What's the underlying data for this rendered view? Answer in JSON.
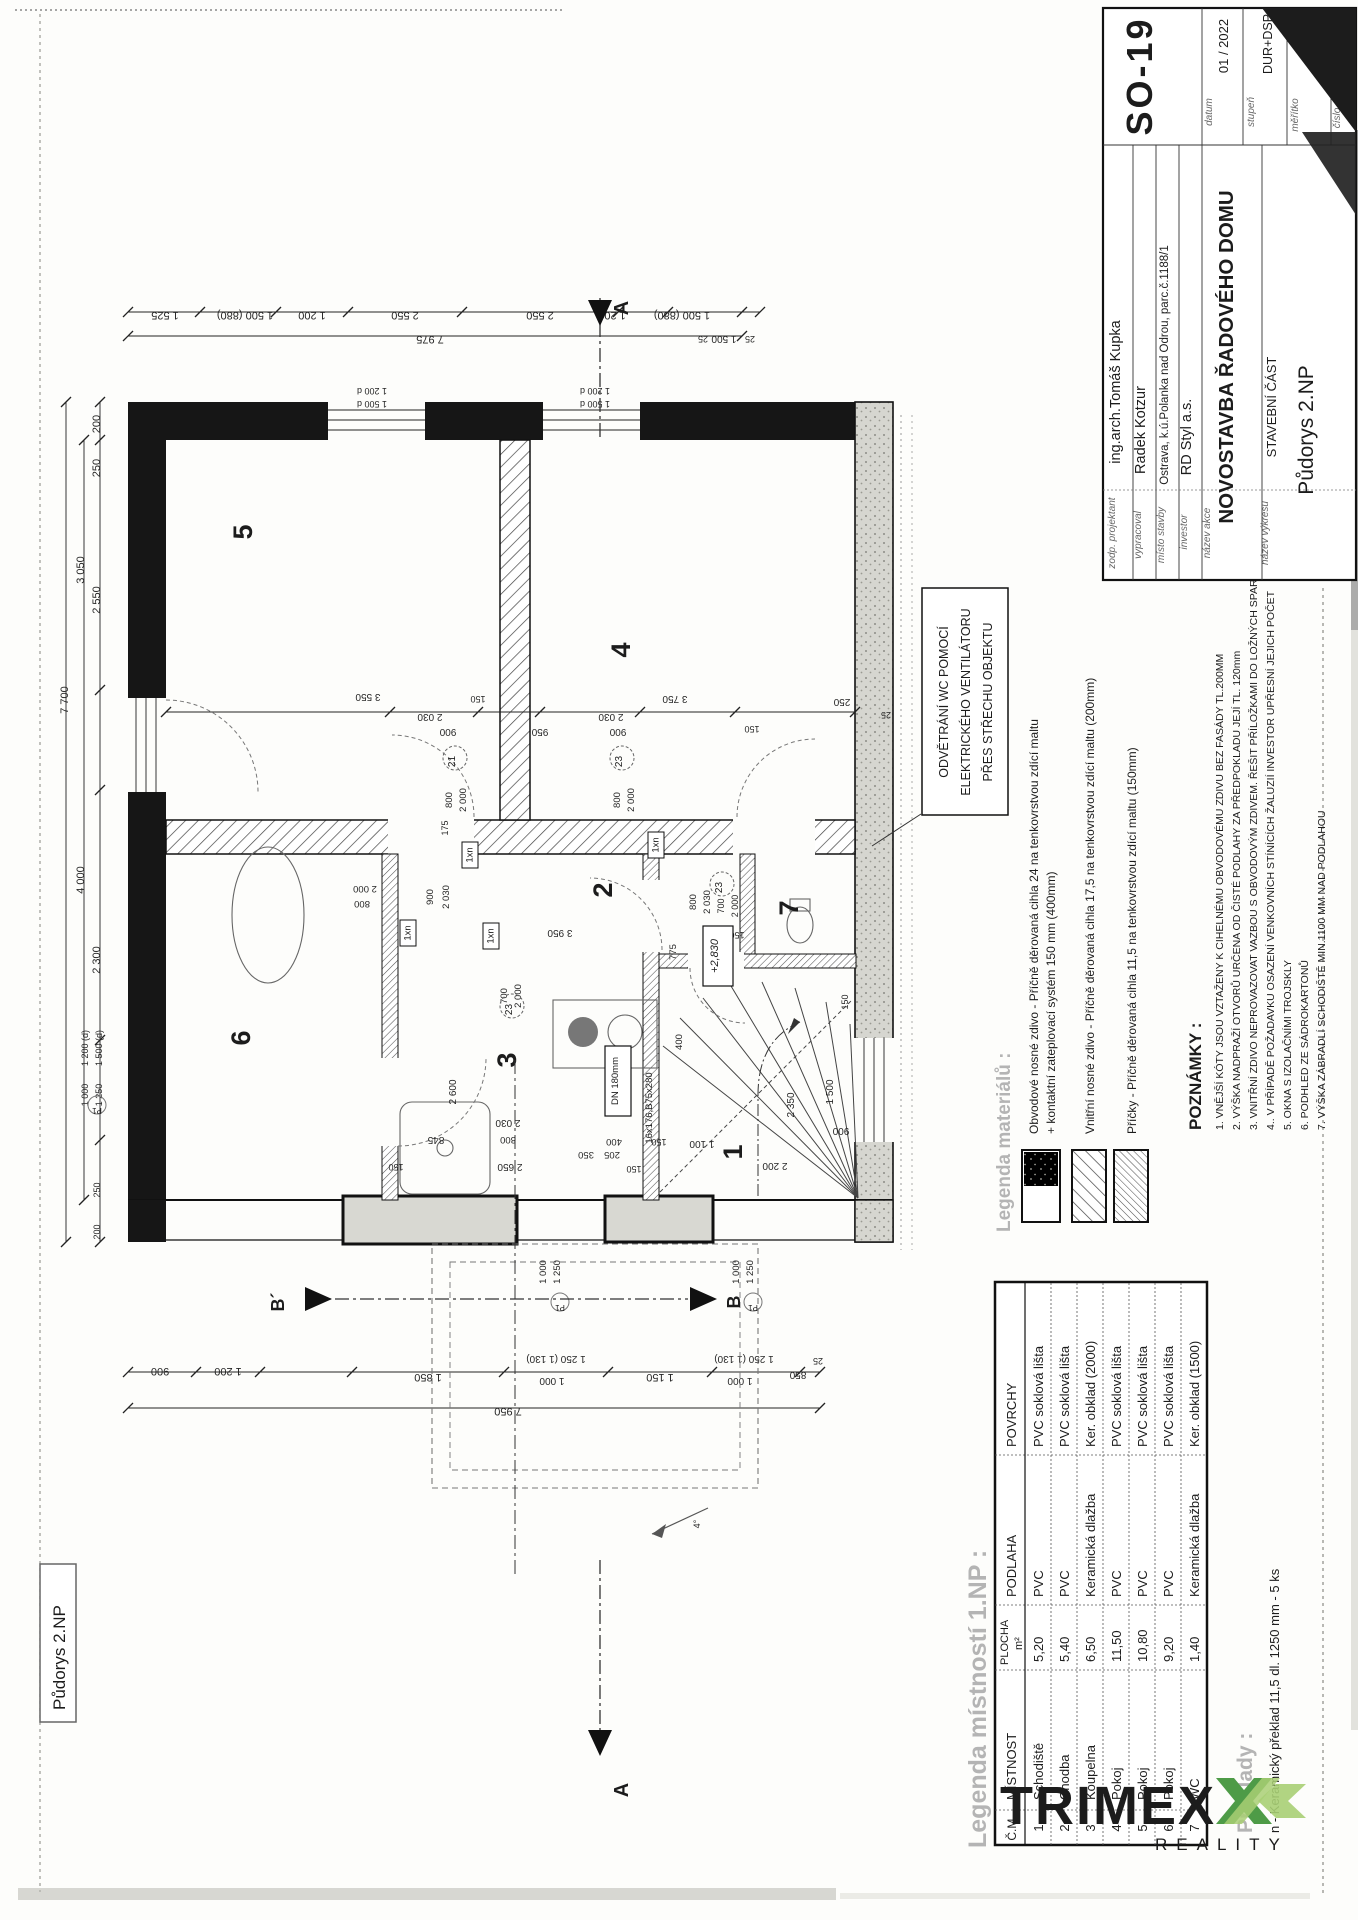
{
  "frame_label": "Půdorys 2.NP",
  "title_block": {
    "rows": [
      {
        "label": "zodp. projektant",
        "value": "ing.arch.Tomáš Kupka"
      },
      {
        "label": "vypracoval",
        "value": "Radek Kotzur"
      },
      {
        "label": "místo stavby",
        "value": "Ostrava, k.ú.Polanka nad Odrou, parc.č.1188/1"
      },
      {
        "label": "investor",
        "value": "RD Styl a.s."
      },
      {
        "label": "název akce",
        "value": "NOVOSTAVBA ŘADOVÉHO DOMU"
      },
      {
        "label": "název výkresu",
        "value_line1": "STAVEBNÍ ČÁST",
        "value_line2": "Půdorys 2.NP"
      }
    ],
    "meta": {
      "datum_label": "datum",
      "datum": "01 / 2022",
      "stupen_label": "stupeň",
      "stupen": "DUR+DSP",
      "meritko_label": "měřítko",
      "meritko": "1:50",
      "cislo_label": "číslo",
      "drawing_no": "SO-19"
    }
  },
  "callout": {
    "lines": [
      "ODVĚTRÁNÍ WC POMOCÍ",
      "ELEKTRICKÉHO VENTILÁTORU",
      "PŘES STŘECHU OBJEKTU"
    ]
  },
  "legend_materials": {
    "title": "Legenda materiálů :",
    "items": [
      {
        "line1": "Obvodové nosné zdivo - Příčně děrovaná cihla 24 na tenkovrstvou zdící maltu",
        "line2": "+ kontaktní zateplovací systém 150 mm (400mm)"
      },
      {
        "line1": "Vnitřní nosné zdivo - Příčně děrovaná cihla 17,5 na tenkovrstvou zdící maltu (200mm)",
        "line2": ""
      },
      {
        "line1": "Příčky - Příčně děrovaná cihla 11,5 na tenkovrstvou zdící maltu (150mm)",
        "line2": ""
      }
    ]
  },
  "notes": {
    "title": "POZNÁMKY :",
    "items": [
      "1. VNĚJŠÍ KÓTY JSOU VZTAŽENY K CIHELNÉMU OBVODOVÉMU ZDIVU BEZ FASÁDY TL.200MM",
      "2. VÝŠKA NADPRAŽÍ OTVORŮ URČENA OD ČISTÉ PODLAHY ZA PŘEDPOKLADU JEJÍ TL. 120mm",
      "3. VNITŘNÍ ZDIVO NEPROVAZOVAT VAZBOU S OBVODOVÝM ZDIVEM. ŘEŠIT PŘÍLOŽKAMI DO LOŽNÝCH SPAR",
      "4.. V PŘÍPADĚ POŽADAVKU OSAZENÍ VENKOVNÍCH STÍNÍCÍCH ŽALUZIÍ INVESTOR UPŘESNÍ JEJICH POČET",
      "5. OKNA S IZOLAČNÍMI TROJSKLY",
      "6. PODHLED ZE SÁDROKARTONŮ",
      "7. VÝŠKA ZÁBRADLÍ SCHODIŠTĚ MIN.1100 MM NAD PODLAHOU"
    ]
  },
  "room_table": {
    "title": "Legenda místností 1.NP :",
    "headers": {
      "cm": "Č.M.",
      "mistnost": "MÍSTNOST",
      "plocha1": "PLOCHA",
      "plocha2": "m²",
      "podlaha": "PODLAHA",
      "povrchy": "POVRCHY"
    },
    "rows": [
      {
        "cm": "1",
        "mistnost": "Schodiště",
        "plocha": "5,20",
        "podlaha": "PVC",
        "povrchy": "PVC soklová lišta"
      },
      {
        "cm": "2",
        "mistnost": "Chodba",
        "plocha": "5,40",
        "podlaha": "PVC",
        "povrchy": "PVC soklová lišta"
      },
      {
        "cm": "3",
        "mistnost": "Koupelna",
        "plocha": "6,50",
        "podlaha": "Keramická dlažba",
        "povrchy": "Ker. obklad (2000)"
      },
      {
        "cm": "4",
        "mistnost": "Pokoj",
        "plocha": "11,50",
        "podlaha": "PVC",
        "povrchy": "PVC soklová lišta"
      },
      {
        "cm": "5",
        "mistnost": "Pokoj",
        "plocha": "10,80",
        "podlaha": "PVC",
        "povrchy": "PVC soklová lišta"
      },
      {
        "cm": "6",
        "mistnost": "Pokoj",
        "plocha": "9,20",
        "podlaha": "PVC",
        "povrchy": "PVC soklová lišta"
      },
      {
        "cm": "7",
        "mistnost": "WC",
        "plocha": "1,40",
        "podlaha": "Keramická dlažba",
        "povrchy": "Ker. obklad (1500)"
      }
    ]
  },
  "preklady": {
    "title": "Překlady :",
    "line": "n - Keramický překlad 11,5 dl. 1250  mm -   5 ks"
  },
  "logo": {
    "brand": "TRIMEX",
    "tagline": "REALITY",
    "green": "#4e9b47",
    "light_green": "#a9cf74",
    "dark": "#4b4b55",
    "gray": "#9b9b9b"
  },
  "sections": {
    "a": "A",
    "b": "B",
    "b_prime": "B´"
  },
  "plan": {
    "boxes": {
      "level": "+2,830",
      "dn": "DN 180mm",
      "stair": "16x176,B75x280",
      "lintel": "1xn"
    },
    "rooms": [
      {
        "t": "5",
        "x": 252,
        "y": 532
      },
      {
        "t": "4",
        "x": 630,
        "y": 650
      },
      {
        "t": "2",
        "x": 612,
        "y": 890
      },
      {
        "t": "7",
        "x": 798,
        "y": 908
      },
      {
        "t": "6",
        "x": 250,
        "y": 1038
      },
      {
        "t": "3",
        "x": 516,
        "y": 1060
      },
      {
        "t": "1",
        "x": 742,
        "y": 1152
      }
    ],
    "door_tags": [
      {
        "t": "21",
        "x": 455,
        "y": 758
      },
      {
        "t": "23",
        "x": 622,
        "y": 758
      },
      {
        "t": "23",
        "x": 722,
        "y": 884
      },
      {
        "t": "23",
        "x": 512,
        "y": 1006
      }
    ],
    "p_tags": [
      {
        "t": "P1",
        "x": 560,
        "y": 1302
      },
      {
        "t": "P1",
        "x": 753,
        "y": 1302
      },
      {
        "t": "P1",
        "x": 97,
        "y": 1105
      }
    ],
    "dims": [
      {
        "t": "1 525",
        "x": 165,
        "y": 312,
        "r": 180
      },
      {
        "t": "1 500 (880)",
        "x": 245,
        "y": 312,
        "r": 180
      },
      {
        "t": "1 200",
        "x": 312,
        "y": 312,
        "r": 180
      },
      {
        "t": "2 550",
        "x": 405,
        "y": 312,
        "r": 180
      },
      {
        "t": "2 550",
        "x": 540,
        "y": 312,
        "r": 180
      },
      {
        "t": "1 200",
        "x": 612,
        "y": 312,
        "r": 180
      },
      {
        "t": "1 500 (880)",
        "x": 682,
        "y": 312,
        "r": 180
      },
      {
        "t": "7 975",
        "x": 430,
        "y": 336,
        "r": 180
      },
      {
        "t": "1 500",
        "x": 724,
        "y": 336,
        "r": 180,
        "s": 10
      },
      {
        "t": "25",
        "x": 703,
        "y": 336,
        "r": 180,
        "s": 9
      },
      {
        "t": "25",
        "x": 750,
        "y": 336,
        "r": 180,
        "s": 9
      },
      {
        "t": "1 200 d",
        "x": 372,
        "y": 388,
        "r": 180,
        "s": 9
      },
      {
        "t": "1 500 d",
        "x": 372,
        "y": 401,
        "r": 180,
        "s": 9
      },
      {
        "t": "1 200 d",
        "x": 595,
        "y": 388,
        "r": 180,
        "s": 9
      },
      {
        "t": "1 500 d",
        "x": 595,
        "y": 401,
        "r": 180,
        "s": 9
      },
      {
        "t": "7 700",
        "x": 68,
        "y": 700,
        "r": -90
      },
      {
        "t": "3 050",
        "x": 84,
        "y": 570,
        "r": -90
      },
      {
        "t": "4 000",
        "x": 84,
        "y": 880,
        "r": -90
      },
      {
        "t": "200",
        "x": 100,
        "y": 424,
        "r": -90
      },
      {
        "t": "250",
        "x": 100,
        "y": 468,
        "r": -90
      },
      {
        "t": "2 550",
        "x": 100,
        "y": 600,
        "r": -90
      },
      {
        "t": "2 300",
        "x": 100,
        "y": 960,
        "r": -90
      },
      {
        "t": "250",
        "x": 100,
        "y": 1190,
        "r": -90,
        "s": 9
      },
      {
        "t": "200",
        "x": 100,
        "y": 1232,
        "r": -90,
        "s": 9
      },
      {
        "t": "1 200 (d)",
        "x": 88,
        "y": 1048,
        "r": -90,
        "s": 9
      },
      {
        "t": "1 500 (d)",
        "x": 102,
        "y": 1048,
        "r": -90,
        "s": 9
      },
      {
        "t": "1 000",
        "x": 88,
        "y": 1095,
        "r": -90,
        "s": 9
      },
      {
        "t": "1 250",
        "x": 102,
        "y": 1095,
        "r": -90,
        "s": 9
      },
      {
        "t": "3 550",
        "x": 368,
        "y": 694,
        "r": 180,
        "s": 10
      },
      {
        "t": "2 030",
        "x": 430,
        "y": 714,
        "r": 180,
        "s": 10
      },
      {
        "t": "900",
        "x": 448,
        "y": 729,
        "r": 180,
        "s": 10
      },
      {
        "t": "150",
        "x": 478,
        "y": 696,
        "r": 180,
        "s": 9
      },
      {
        "t": "950",
        "x": 540,
        "y": 729,
        "r": 180,
        "s": 10
      },
      {
        "t": "2 030",
        "x": 611,
        "y": 714,
        "r": 180,
        "s": 10
      },
      {
        "t": "900",
        "x": 618,
        "y": 729,
        "r": 180,
        "s": 10
      },
      {
        "t": "3 750",
        "x": 675,
        "y": 696,
        "r": 180,
        "s": 10
      },
      {
        "t": "150",
        "x": 752,
        "y": 726,
        "r": 180,
        "s": 9
      },
      {
        "t": "800",
        "x": 452,
        "y": 800,
        "r": -90,
        "s": 9.5
      },
      {
        "t": "2 000",
        "x": 466,
        "y": 800,
        "r": -90,
        "s": 9.5
      },
      {
        "t": "175",
        "x": 448,
        "y": 828,
        "r": -90,
        "s": 9
      },
      {
        "t": "800",
        "x": 620,
        "y": 800,
        "r": -90,
        "s": 9.5
      },
      {
        "t": "2 000",
        "x": 634,
        "y": 800,
        "r": -90,
        "s": 9.5
      },
      {
        "t": "900",
        "x": 433,
        "y": 897,
        "r": -90,
        "s": 9.5
      },
      {
        "t": "2 030",
        "x": 449,
        "y": 897,
        "r": -90,
        "s": 9.5
      },
      {
        "t": "700",
        "x": 507,
        "y": 996,
        "r": -90,
        "s": 9.5
      },
      {
        "t": "2 000",
        "x": 521,
        "y": 996,
        "r": -90,
        "s": 9.5
      },
      {
        "t": "800",
        "x": 696,
        "y": 902,
        "r": -90,
        "s": 9.5
      },
      {
        "t": "2 030",
        "x": 710,
        "y": 902,
        "r": -90,
        "s": 9.5
      },
      {
        "t": "700",
        "x": 724,
        "y": 906,
        "r": -90,
        "s": 9
      },
      {
        "t": "2 000",
        "x": 738,
        "y": 906,
        "r": -90,
        "s": 9
      },
      {
        "t": "775",
        "x": 676,
        "y": 952,
        "r": -90,
        "s": 9.5
      },
      {
        "t": "400",
        "x": 682,
        "y": 1042,
        "r": -90,
        "s": 9.5
      },
      {
        "t": "2 350",
        "x": 794,
        "y": 1105,
        "r": -90,
        "s": 10
      },
      {
        "t": "1 500",
        "x": 833,
        "y": 1092,
        "r": -90,
        "s": 10
      },
      {
        "t": "150",
        "x": 848,
        "y": 1002,
        "r": -90,
        "s": 9
      },
      {
        "t": "2 600",
        "x": 456,
        "y": 1092,
        "r": -90,
        "s": 10
      },
      {
        "t": "2 000",
        "x": 365,
        "y": 886,
        "r": 180,
        "s": 9.5
      },
      {
        "t": "800",
        "x": 362,
        "y": 901,
        "r": 180,
        "s": 9.5
      },
      {
        "t": "3 950",
        "x": 560,
        "y": 930,
        "r": 180,
        "s": 10
      },
      {
        "t": "150",
        "x": 737,
        "y": 932,
        "r": 180,
        "s": 9
      },
      {
        "t": "900",
        "x": 841,
        "y": 1128,
        "r": 180,
        "s": 10
      },
      {
        "t": "250",
        "x": 842,
        "y": 699,
        "r": 180,
        "s": 10
      },
      {
        "t": "25",
        "x": 886,
        "y": 712,
        "r": 180,
        "s": 9
      },
      {
        "t": "2 030",
        "x": 508,
        "y": 1120,
        "r": 180,
        "s": 10
      },
      {
        "t": "800",
        "x": 508,
        "y": 1137,
        "r": 180,
        "s": 9.5
      },
      {
        "t": "845",
        "x": 436,
        "y": 1137,
        "r": 180,
        "s": 10
      },
      {
        "t": "2 650",
        "x": 510,
        "y": 1164,
        "r": 180,
        "s": 10
      },
      {
        "t": "350",
        "x": 586,
        "y": 1152,
        "r": 180,
        "s": 9.5
      },
      {
        "t": "205",
        "x": 612,
        "y": 1152,
        "r": 180,
        "s": 9.5
      },
      {
        "t": "150",
        "x": 396,
        "y": 1164,
        "r": 180,
        "s": 9
      },
      {
        "t": "150",
        "x": 634,
        "y": 1166,
        "r": 180,
        "s": 9
      },
      {
        "t": "400",
        "x": 614,
        "y": 1139,
        "r": 180,
        "s": 9.5
      },
      {
        "t": "150",
        "x": 659,
        "y": 1139,
        "r": 180,
        "s": 9
      },
      {
        "t": "1 100",
        "x": 702,
        "y": 1141,
        "r": 180,
        "s": 10
      },
      {
        "t": "2 200",
        "x": 775,
        "y": 1163,
        "r": 180,
        "s": 10
      },
      {
        "t": "900",
        "x": 160,
        "y": 1368,
        "r": 180
      },
      {
        "t": "1 200",
        "x": 228,
        "y": 1368,
        "r": 180
      },
      {
        "t": "1 850",
        "x": 428,
        "y": 1374,
        "r": 180
      },
      {
        "t": "1 250 (1 130)",
        "x": 556,
        "y": 1356,
        "r": 180,
        "s": 10
      },
      {
        "t": "1 000",
        "x": 552,
        "y": 1378,
        "r": 180,
        "s": 10
      },
      {
        "t": "1 150",
        "x": 660,
        "y": 1374,
        "r": 180
      },
      {
        "t": "1 250 (1 130)",
        "x": 744,
        "y": 1356,
        "r": 180,
        "s": 10
      },
      {
        "t": "1 000",
        "x": 740,
        "y": 1378,
        "r": 180,
        "s": 10
      },
      {
        "t": "7 950",
        "x": 508,
        "y": 1408,
        "r": 180
      },
      {
        "t": "850",
        "x": 798,
        "y": 1372,
        "r": 180,
        "s": 10
      },
      {
        "t": "25",
        "x": 818,
        "y": 1358,
        "r": 180,
        "s": 9
      },
      {
        "t": "1 000",
        "x": 546,
        "y": 1272,
        "r": -90,
        "s": 9.5
      },
      {
        "t": "1 250",
        "x": 560,
        "y": 1272,
        "r": -90,
        "s": 9.5
      },
      {
        "t": "1 000",
        "x": 739,
        "y": 1272,
        "r": -90,
        "s": 9.5
      },
      {
        "t": "1 250",
        "x": 753,
        "y": 1272,
        "r": -90,
        "s": 9.5
      },
      {
        "t": "4°",
        "x": 700,
        "y": 1524,
        "r": -90,
        "s": 9
      }
    ]
  }
}
